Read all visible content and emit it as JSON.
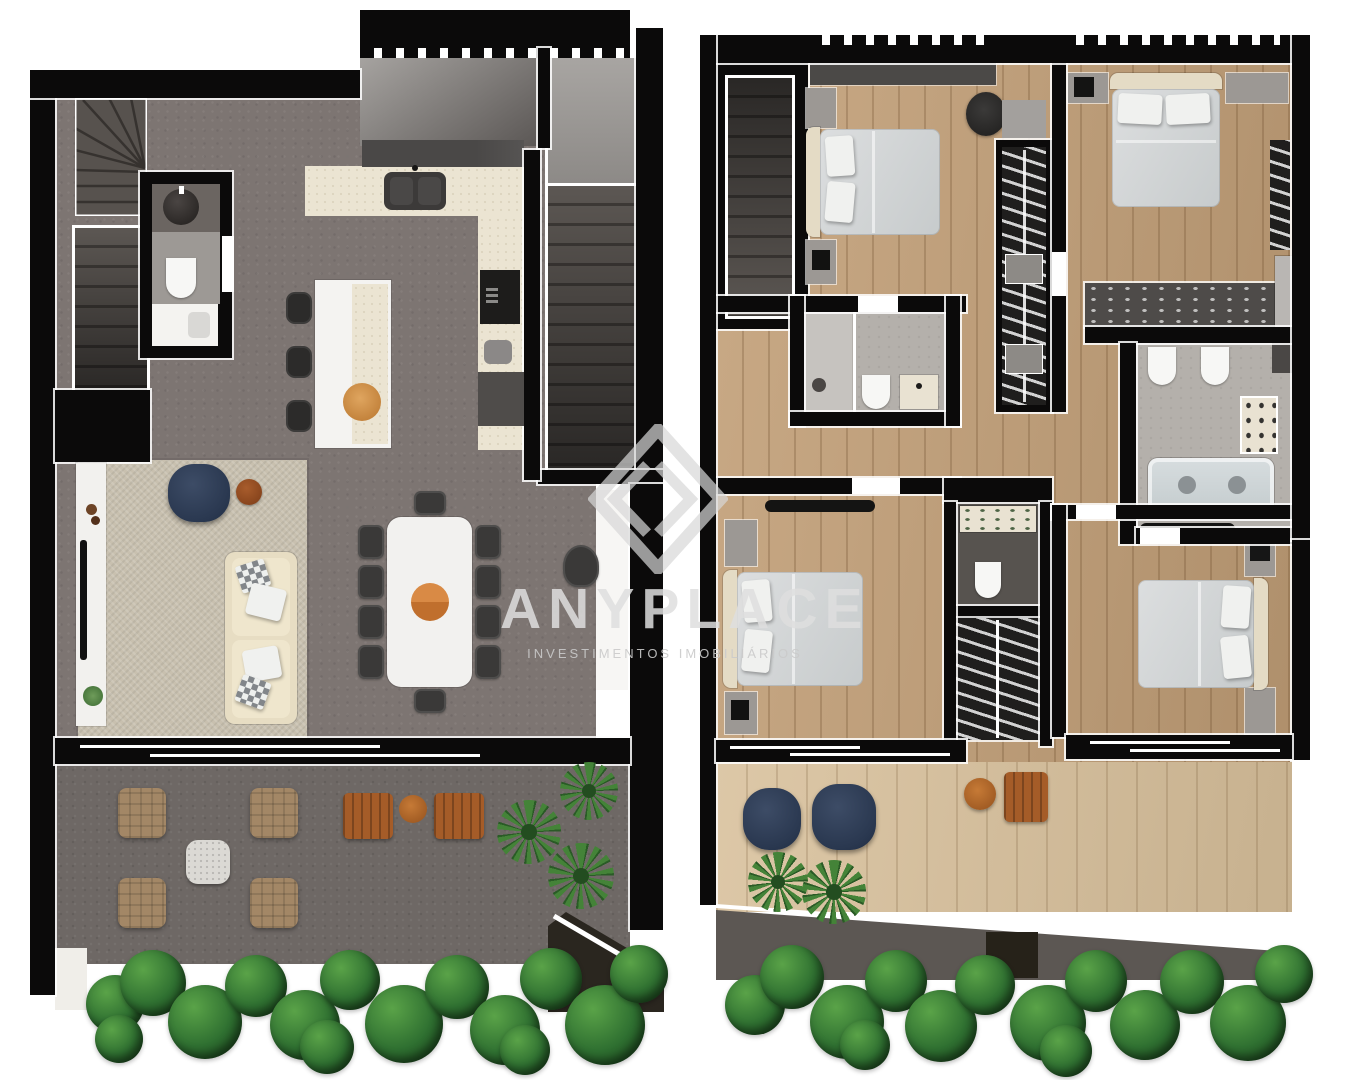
{
  "watermark": {
    "title": "ANYPLACE",
    "subtitle": "INVESTIMENTOS IMOBILIÁRIOS",
    "logo": "diamond-chevron-icon"
  },
  "colors": {
    "background": "#ffffff",
    "wall": "#0b0a0a",
    "concrete_floor": "#7d7572",
    "terrace_concrete": "#6e6865",
    "wood_floor": "#c3a078",
    "deck_wood": "#d8c09b",
    "kitchen_counter_cream": "#ebe4d2",
    "rug_beige": "#c8c0af",
    "sofa_cream": "#e4dbc5",
    "accent_navy": "#2e3c54",
    "accent_orange": "#b5672c",
    "plant_green": "#2f7031",
    "watermark_gray": "#dedede"
  },
  "plans": [
    {
      "name": "ground-floor",
      "position": "left",
      "rooms": [
        "winder-staircase",
        "lower-staircase",
        "bathroom",
        "kitchen",
        "dining-room",
        "living-room",
        "upper-patio",
        "side-stairwell",
        "terrace",
        "garden-border"
      ],
      "furniture": [
        "washbasin",
        "toilet",
        "vanity",
        "kitchen-counter",
        "double-sink",
        "oven-tower",
        "kitchen-island",
        "bar-stools",
        "serving-tray",
        "dining-table",
        "dining-chairs",
        "centerpiece",
        "tv-sideboard",
        "tv",
        "area-rug",
        "navy-pouf",
        "round-side-table",
        "sofa",
        "pillows",
        "desk-chair",
        "lounge-armchairs",
        "stone-coffee-table",
        "wooden-chairs",
        "round-wood-table",
        "ferns",
        "leaf-hedge"
      ]
    },
    {
      "name": "upper-floor",
      "position": "right",
      "rooms": [
        "staircase",
        "bedroom-1",
        "bedroom-2",
        "bedroom-3",
        "bedroom-4",
        "bathroom-1",
        "bathroom-2",
        "wc",
        "wardrobe-corridor",
        "closets",
        "hallway",
        "roof-deck",
        "garden-border"
      ],
      "furniture": [
        "double-beds",
        "nightstands",
        "desk",
        "office-chair",
        "hanging-wardrobes",
        "shower",
        "toilets",
        "vanities",
        "double-bathtub",
        "dresser",
        "navy-poufs",
        "ferns",
        "round-wood-table",
        "wooden-bench",
        "leaf-hedge"
      ]
    }
  ]
}
